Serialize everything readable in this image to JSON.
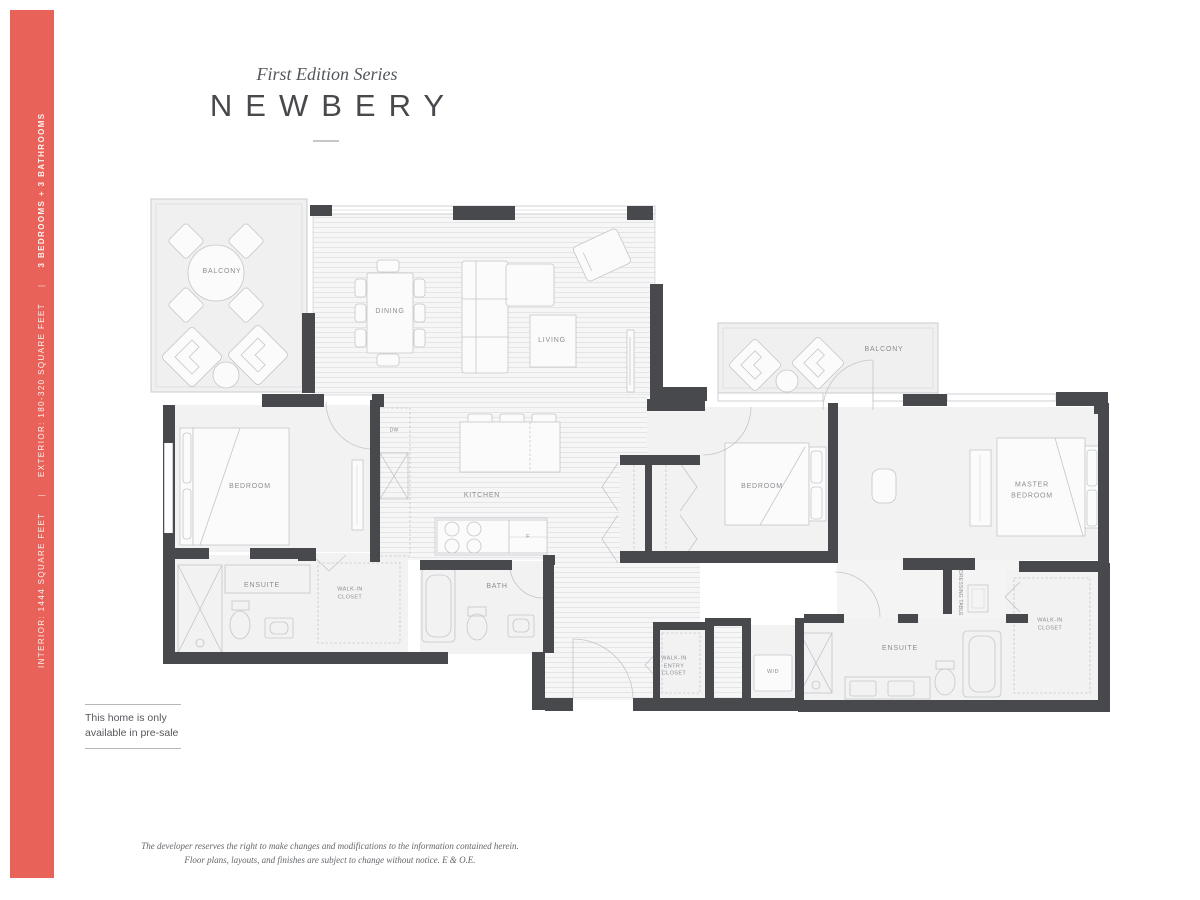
{
  "colors": {
    "sidebar_coral": "#e9625a",
    "wall_dark": "#47494c",
    "line_gray": "#c3c6c9",
    "floor_light": "#f2f2f3"
  },
  "sidebar": {
    "interior": "INTERIOR: 1444 SQUARE FEET",
    "separator": "|",
    "exterior": "EXTERIOR: 180-320 SQUARE FEET",
    "bed_bath": "3 BEDROOMS + 3 BATHROOMS"
  },
  "header": {
    "series": "First Edition Series",
    "title": "NEWBERY"
  },
  "plan": {
    "rooms": {
      "balcony1": "BALCONY",
      "balcony2": "BALCONY",
      "dining": "DINING",
      "living": "LIVING",
      "kitchen": "KITCHEN",
      "bedroom1": "BEDROOM",
      "bedroom2": "BEDROOM",
      "master": "MASTER\nBEDROOM",
      "ensuite1": "ENSUITE",
      "ensuite2": "ENSUITE",
      "bath": "BATH",
      "walkin1": "WALK-IN\nCLOSET",
      "walkin2": "WALK-IN\nCLOSET",
      "entry_closet": "WALK-IN\nENTRY\nCLOSET",
      "wd": "W/D",
      "dw": "DW",
      "fridge": "F",
      "dressing": "DRESSING TABLE"
    }
  },
  "presale": {
    "note": "This home is only\navailable in pre-sale"
  },
  "footer": {
    "disclaimer": "The developer reserves the right to make changes and modifications to the information contained herein.\nFloor plans, layouts, and finishes are subject to change without notice. E & O.E."
  }
}
